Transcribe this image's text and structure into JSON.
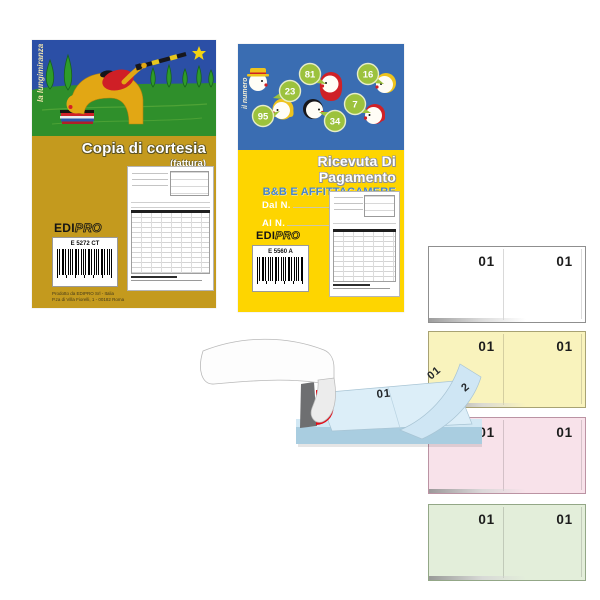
{
  "book1": {
    "side_label": "la lungimiranza",
    "title": "Copia di cortesia",
    "subtitle": "(fattura)",
    "spec": "33x3 autoricalcanti",
    "brand_bold": "EDI",
    "brand_light": "PRO",
    "product_code": "E 5272 CT",
    "footer_line1": "Prodotto da EDIPRO Srl - Italia",
    "footer_line2": "P.za di Villa Fiorelli, 1 - 00182 Roma"
  },
  "book2": {
    "side_label": "il numero",
    "title": "Ricevuta Di Pagamento",
    "subtitle": "B&B E AFFITTACAMERE",
    "spec": "25x2 autoricalcanti",
    "from_label": "Dal N.",
    "to_label": "Al N.",
    "brand_bold": "EDI",
    "brand_light": "PRO",
    "product_code": "E 5560 A",
    "bubbles": [
      "23",
      "81",
      "16",
      "95",
      "7",
      "34"
    ]
  },
  "pads": [
    {
      "color_name": "white",
      "hex": "#ffffff",
      "left": "01",
      "right": "01"
    },
    {
      "color_name": "yellow",
      "hex": "#f9f3bd",
      "left": "01",
      "right": "01"
    },
    {
      "color_name": "pink",
      "hex": "#f8e2ea",
      "left": "01",
      "right": "01"
    },
    {
      "color_name": "green",
      "hex": "#e3eeda",
      "left": "01",
      "right": "01"
    }
  ],
  "open_pad": {
    "flat_page_number": "01",
    "flipping_page_number": "01",
    "next_page_digit": "2"
  },
  "colors": {
    "book1_cover": "#c49a1e",
    "book1_sky": "#2b4fa6",
    "book1_grass": "#2f8f2b",
    "book2_cover": "#fed500",
    "book2_sky": "#3a6db2",
    "bubble_green": "#9cc23d",
    "subtitle_blue": "#4a86c8",
    "page_blue": "#d9ecf7",
    "spine_red": "#e30b17",
    "spine_gray": "#6e6f71"
  }
}
